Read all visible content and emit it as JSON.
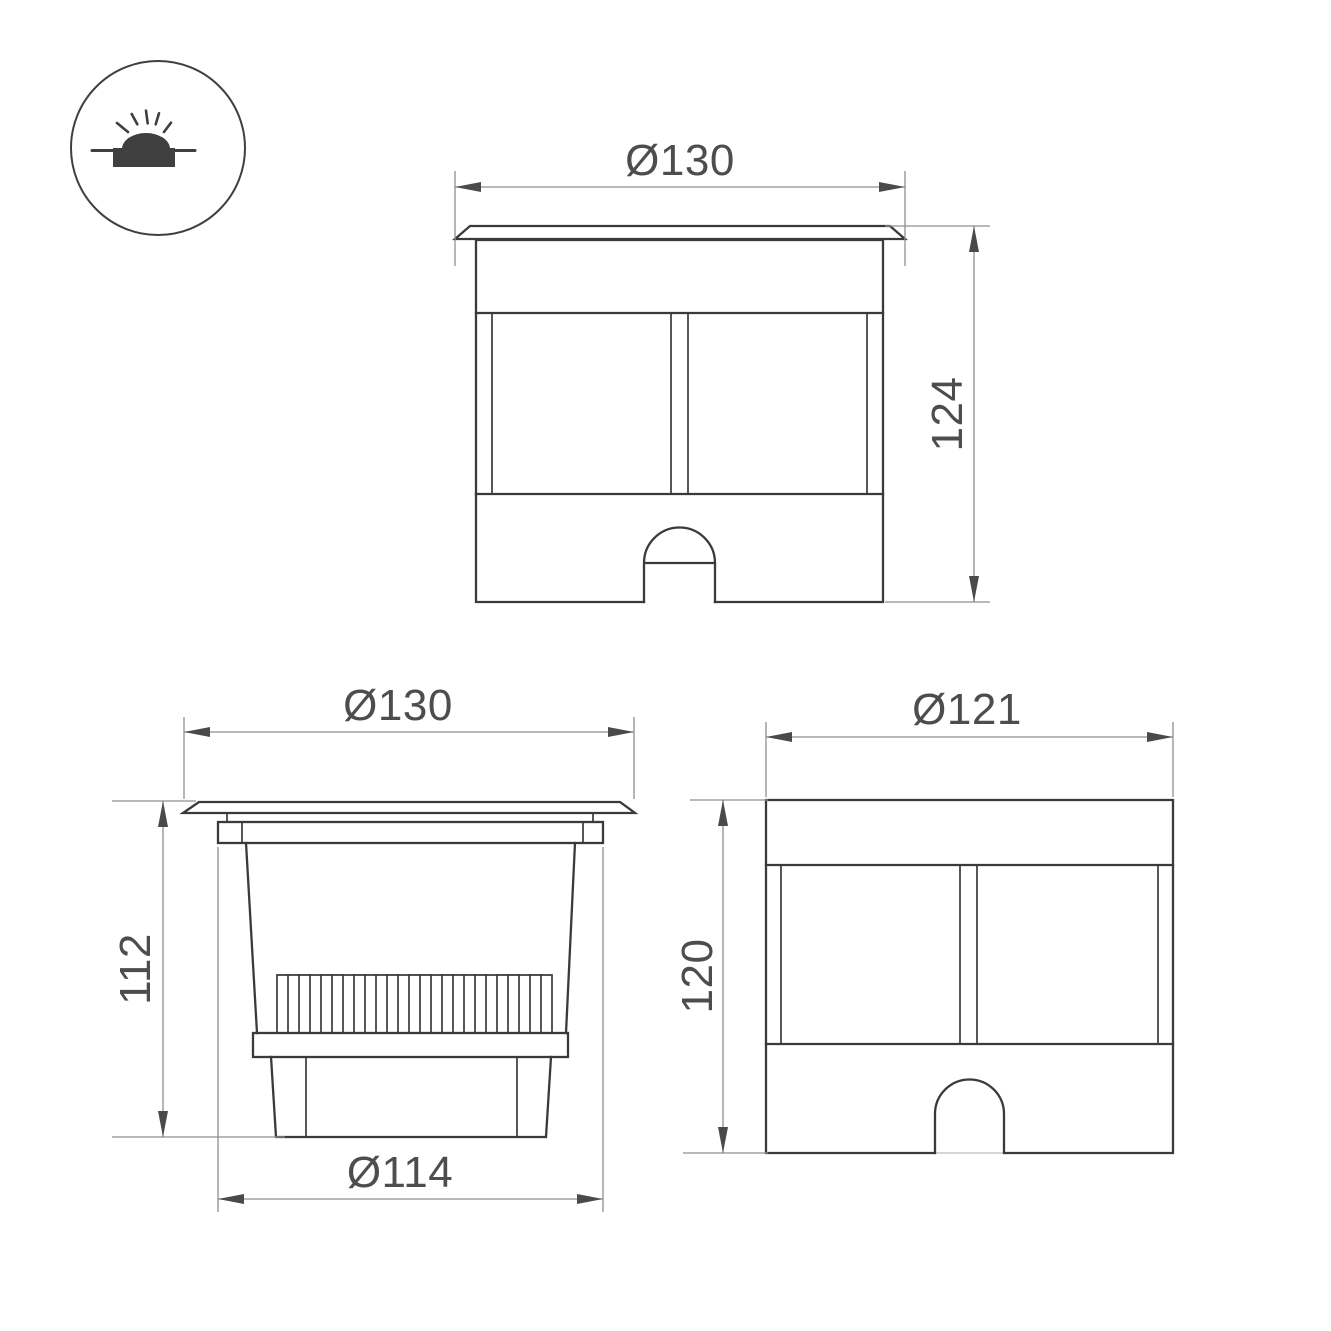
{
  "icon": {
    "type": "recessed-ground-luminaire-symbol"
  },
  "views": {
    "front_flange_view": {
      "diameter_label": "Ø130",
      "height_label": "124"
    },
    "section_view": {
      "diameter_label": "Ø130",
      "height_label": "112",
      "pot_diameter_label": "Ø114"
    },
    "housing_view": {
      "diameter_label": "Ø121",
      "height_label": "120"
    }
  },
  "colors": {
    "outline": "#3a3a3a",
    "dim_line": "#8f8f8f",
    "dim_text": "#4d4d4d",
    "arrow": "#4a4a4a",
    "icon_fill": "#3f3f3f",
    "background": "#ffffff"
  }
}
